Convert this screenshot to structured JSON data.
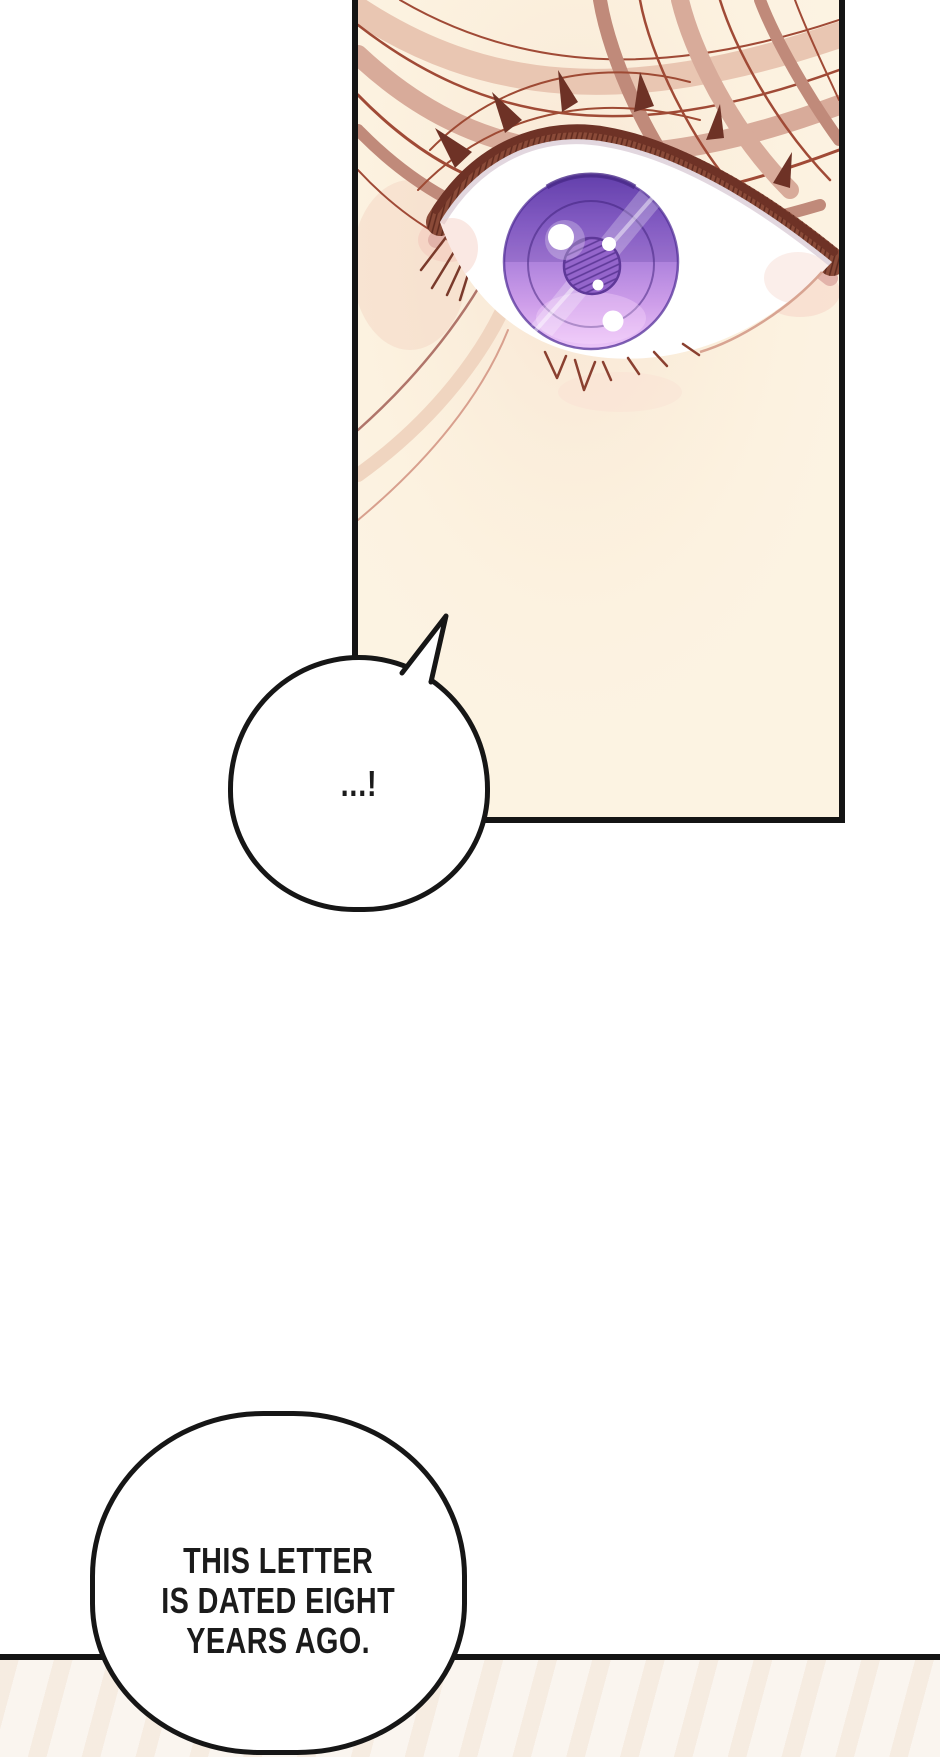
{
  "page": {
    "kind": "comic page segment",
    "colors": {
      "background": "#ffffff",
      "ink": "#161616"
    }
  },
  "panel_eye": {
    "colors": {
      "background": "#fcf3e2",
      "border": "#141414",
      "hair_band_light": "#d8ab9a",
      "hair_band_mid": "#c08a7a",
      "hair_line": "#a04a36",
      "lash_band": "#8a4a38",
      "lash_dark": "#6e3226",
      "lid_pink": "#e2b3aa",
      "skin_blush": "#f3cbbd",
      "sclera": "#ffffff",
      "iris_top": "#6b46b4",
      "iris_mid": "#b185de",
      "iris_bottom": "#ecc6f8",
      "pupil": "#9465cb",
      "pupil_hatch": "#5e3898",
      "highlight": "#ffffff"
    }
  },
  "speech_bubbles": {
    "small": {
      "text": "...!",
      "fill": "#ffffff",
      "border": "#161616"
    },
    "large": {
      "lines": [
        "THIS LETTER",
        "IS DATED EIGHT",
        "YEARS AGO."
      ],
      "fill": "#ffffff",
      "border": "#161616"
    }
  },
  "panel_divider": {
    "color": "#141414"
  },
  "next_panel": {
    "tint": "#faf5ef"
  }
}
